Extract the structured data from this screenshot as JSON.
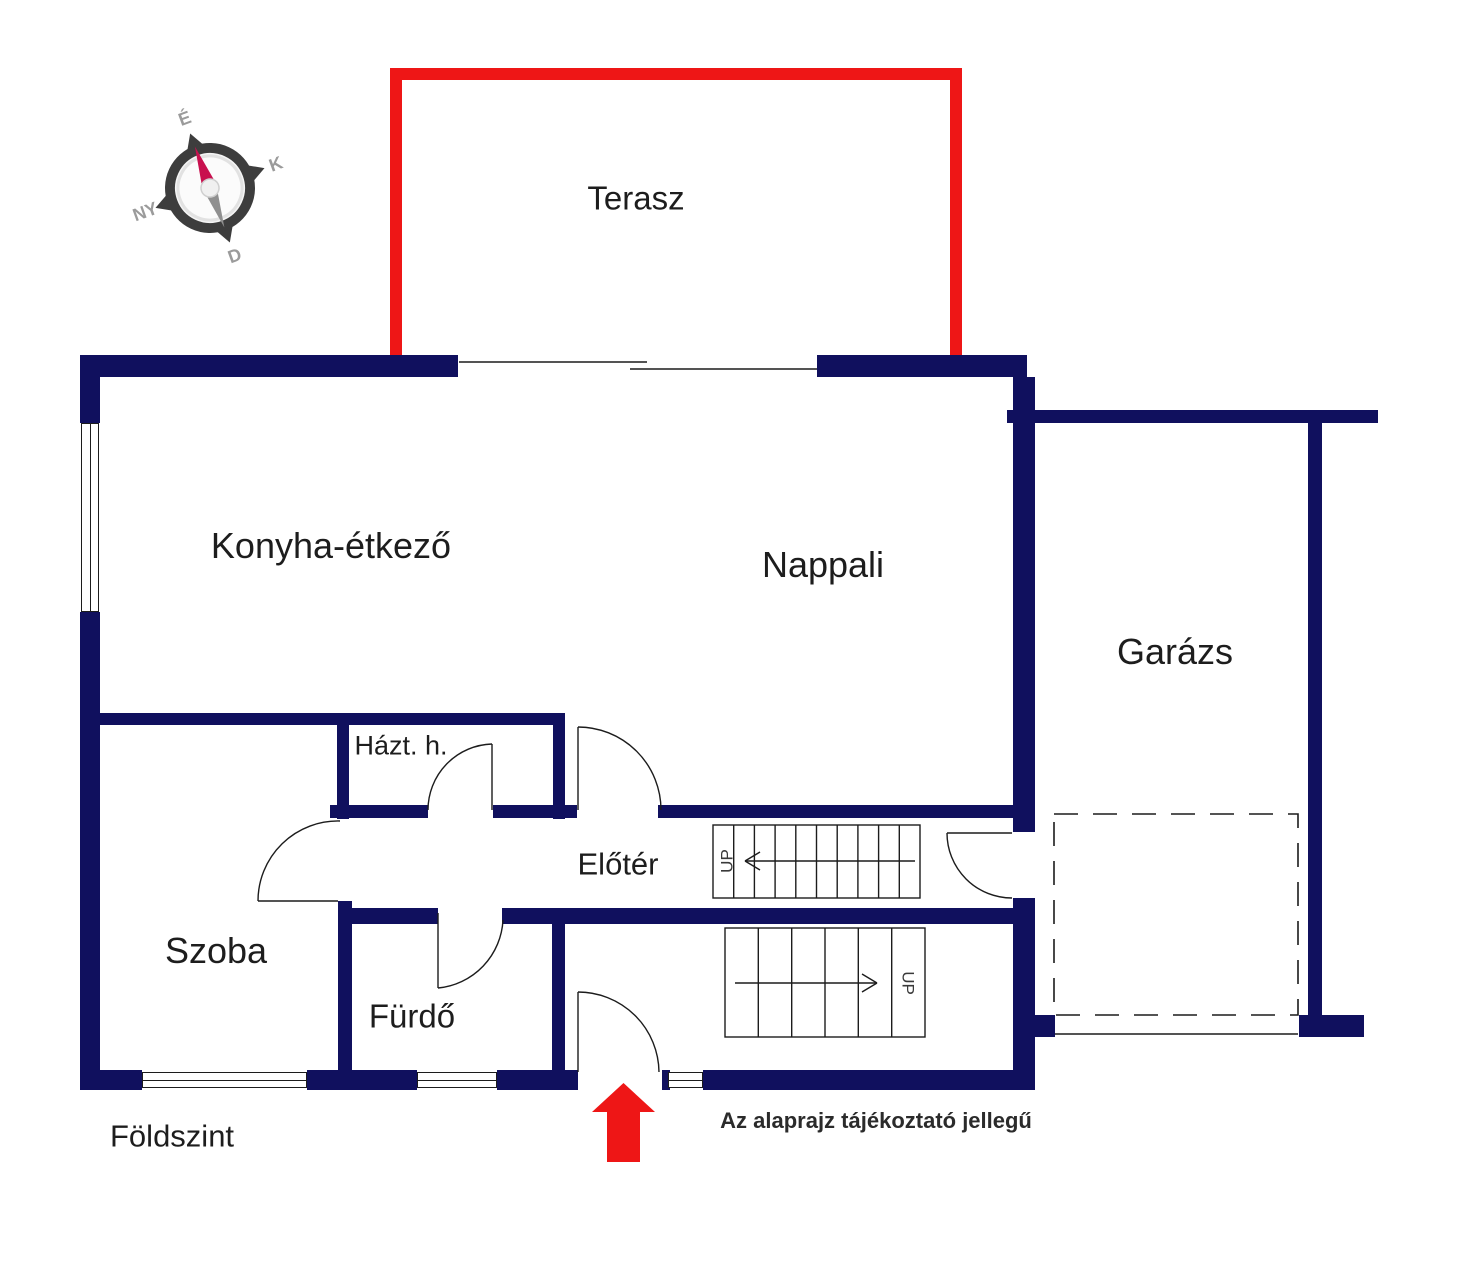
{
  "floor_title": "Földszint",
  "disclaimer": "Az alaprajz tájékoztató jellegű",
  "compass": {
    "north": "É",
    "east": "K",
    "south": "D",
    "west": "NY"
  },
  "rooms": [
    {
      "id": "terasz",
      "label": "Terasz"
    },
    {
      "id": "konyha",
      "label": "Konyha-étkező"
    },
    {
      "id": "nappali",
      "label": "Nappali"
    },
    {
      "id": "garazs",
      "label": "Garázs"
    },
    {
      "id": "hazt",
      "label": "Házt. h."
    },
    {
      "id": "eloter",
      "label": "Előtér"
    },
    {
      "id": "szoba",
      "label": "Szoba"
    },
    {
      "id": "furdo",
      "label": "Fürdő"
    }
  ],
  "stairs": [
    {
      "label": "UP",
      "direction": "left",
      "treads": 10
    },
    {
      "label": "UP",
      "direction": "right",
      "treads": 6
    }
  ],
  "colors": {
    "wall": "#10105e",
    "terrace": "#ee1616",
    "line": "#1c1c1c",
    "text": "#1d1d1d"
  }
}
